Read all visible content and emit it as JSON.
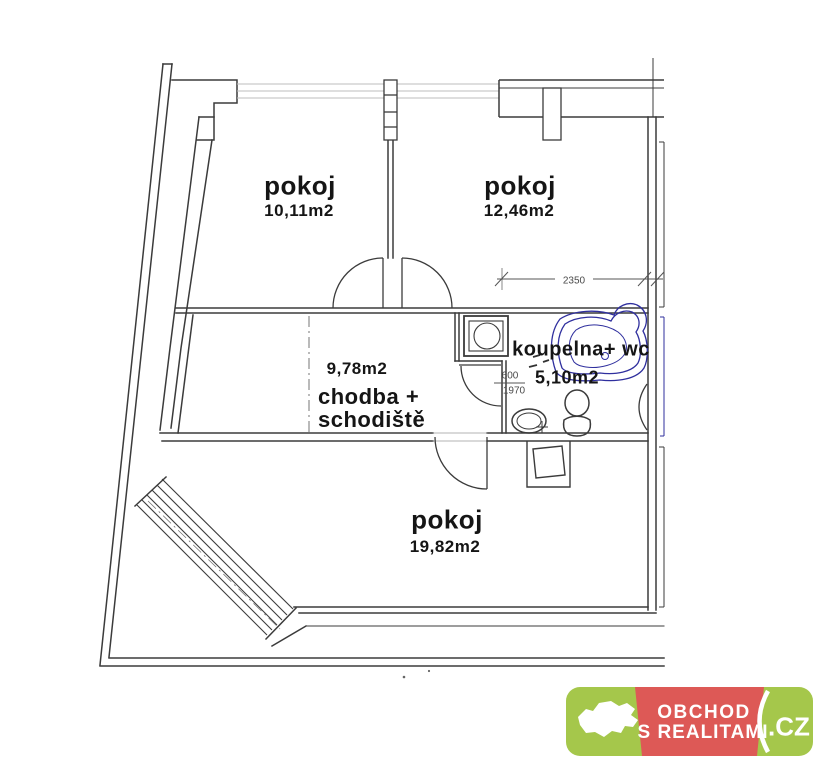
{
  "plan": {
    "rooms": [
      {
        "name_label": "pokoj",
        "area_label": "10,11m2"
      },
      {
        "name_label": "pokoj",
        "area_label": "12,46m2"
      },
      {
        "name_line1": "chodba +",
        "name_line2": "schodiště",
        "area_label": "9,78m2"
      },
      {
        "name_label": "koupelna+ wc",
        "area_label": "5,10m2"
      },
      {
        "name_label": "pokoj",
        "area_label": "19,82m2"
      }
    ],
    "dimension_labels": {
      "room_width": "2350",
      "door_width": "600",
      "door_height": "1970"
    },
    "fixtures": [
      "washing-machine",
      "bathtub",
      "toilet",
      "sink"
    ],
    "colors": {
      "wall_line": "#3b3b3b",
      "glazing_line": "#bcbcbc",
      "plumbing_blue": "#2f2f9e",
      "dim_line": "#555555"
    }
  },
  "watermark": {
    "brand_line1": "OBCHOD",
    "brand_line2": "S REALITAMI",
    "tld": ".CZ",
    "map_icon": "czech-republic-map-icon",
    "colors": {
      "green": "#a5c74b",
      "red": "#dd5956",
      "text": "#ffffff"
    }
  }
}
